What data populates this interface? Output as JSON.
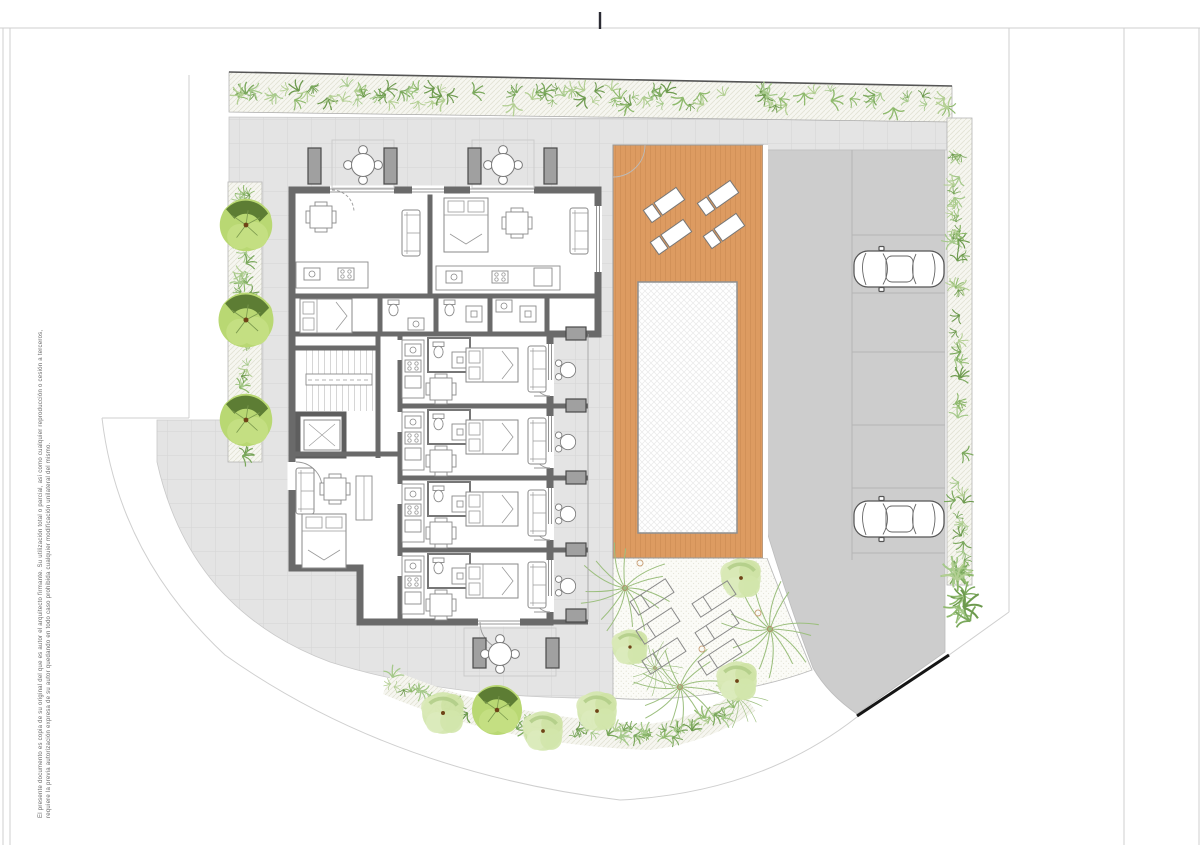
{
  "document": {
    "kind": "architectural-site-plan",
    "disclaimer": {
      "line1": "El presente documento es copia de su original del que es autor el arquitecto firmante. Su utilización total o parcial, así como cualquier reproducción o cesión a terceros,",
      "line2": "requiere la previa autorización expresa de su autor quedando en todo caso prohibida cualquier modificación unilateral del mismo."
    }
  },
  "palette": {
    "plaza": "#e4e4e4",
    "plaza_grid": "#d5d5d5",
    "driveway": "#cdcdcd",
    "driveway_line": "#b5b5b5",
    "deck": "#dd9b61",
    "deck_plank": "#c6854d",
    "pool_border": "#8f8f8f",
    "wall": "#6a6a6a",
    "hedge_bg": "#f6f6f0",
    "hedge_hatch": "#e2e2d4",
    "garden_bg": "#fbfbf7",
    "garden_dot": "#dcdccb",
    "tree_light": "#b9d873",
    "tree_dark": "#55752f",
    "tree_pale": "#d2e5ab",
    "tree_patch": "#aecb84",
    "trunk_dot": "#6f4317",
    "palm": "#9cbf7e",
    "frame_line": "#cfcfcf",
    "cut_mark": "#2b2b33",
    "exit_edge": "#161616",
    "sprig_greens": [
      "#8fba6d",
      "#7aa85c",
      "#a5c98a",
      "#6d9a4e",
      "#b3cf93"
    ]
  },
  "site": {
    "parking": {
      "stall_lines_y": [
        235,
        293,
        352,
        425,
        488,
        553
      ],
      "cars": [
        {
          "x": 853,
          "y": 248,
          "rot": 0
        },
        {
          "x": 853,
          "y": 498,
          "rot": 0
        }
      ]
    },
    "trees_left": [
      {
        "x": 246,
        "y": 225,
        "s": 1.05
      },
      {
        "x": 246,
        "y": 320,
        "s": 1.1
      },
      {
        "x": 246,
        "y": 420,
        "s": 1.05
      }
    ],
    "trees_bottom": [
      {
        "x": 443,
        "y": 713,
        "s": 0.95,
        "kind": "pale"
      },
      {
        "x": 497,
        "y": 710,
        "s": 1.0,
        "kind": "two"
      },
      {
        "x": 543,
        "y": 731,
        "s": 0.9,
        "kind": "pale"
      },
      {
        "x": 597,
        "y": 711,
        "s": 0.9,
        "kind": "pale"
      }
    ],
    "trees_garden": [
      {
        "x": 630,
        "y": 647,
        "s": 0.8,
        "kind": "pale"
      },
      {
        "x": 741,
        "y": 578,
        "s": 0.9,
        "kind": "pale"
      },
      {
        "x": 737,
        "y": 681,
        "s": 0.9,
        "kind": "pale"
      }
    ],
    "palms": [
      {
        "x": 625,
        "y": 588,
        "s": 1.0
      },
      {
        "x": 680,
        "y": 687,
        "s": 1.0
      },
      {
        "x": 770,
        "y": 629,
        "s": 1.05
      },
      {
        "x": 655,
        "y": 668,
        "s": 0.6
      },
      {
        "x": 738,
        "y": 698,
        "s": 0.65
      }
    ],
    "deck_loungers": [
      {
        "x": 664,
        "y": 205,
        "rot": -35
      },
      {
        "x": 718,
        "y": 198,
        "rot": -35
      },
      {
        "x": 671,
        "y": 237,
        "rot": -35
      },
      {
        "x": 724,
        "y": 231,
        "rot": -35
      }
    ],
    "garden_loungers": [
      {
        "x": 652,
        "y": 597,
        "rot": -33
      },
      {
        "x": 714,
        "y": 599,
        "rot": -33
      },
      {
        "x": 658,
        "y": 626,
        "rot": -33
      },
      {
        "x": 717,
        "y": 628,
        "rot": -33
      },
      {
        "x": 664,
        "y": 656,
        "rot": -33
      },
      {
        "x": 720,
        "y": 657,
        "rot": -33
      }
    ],
    "terrace_tables": [
      {
        "x": 363,
        "y": 165
      },
      {
        "x": 503,
        "y": 165
      },
      {
        "x": 500,
        "y": 654
      }
    ],
    "balcony_tables": [
      {
        "x": 568,
        "y": 370
      },
      {
        "x": 568,
        "y": 442
      },
      {
        "x": 568,
        "y": 514
      },
      {
        "x": 568,
        "y": 586
      }
    ],
    "planters": [
      {
        "x": 308,
        "y": 148,
        "w": 13,
        "h": 36
      },
      {
        "x": 384,
        "y": 148,
        "w": 13,
        "h": 36
      },
      {
        "x": 468,
        "y": 148,
        "w": 13,
        "h": 36
      },
      {
        "x": 544,
        "y": 148,
        "w": 13,
        "h": 36
      },
      {
        "x": 473,
        "y": 638,
        "w": 13,
        "h": 30
      },
      {
        "x": 546,
        "y": 638,
        "w": 13,
        "h": 30
      },
      {
        "x": 566,
        "y": 399,
        "w": 20,
        "h": 13
      },
      {
        "x": 566,
        "y": 471,
        "w": 20,
        "h": 13
      },
      {
        "x": 566,
        "y": 543,
        "w": 20,
        "h": 13
      },
      {
        "x": 566,
        "y": 327,
        "w": 20,
        "h": 13
      },
      {
        "x": 566,
        "y": 609,
        "w": 20,
        "h": 13
      }
    ],
    "irrigation_dots": [
      {
        "x": 640,
        "y": 563
      },
      {
        "x": 702,
        "y": 649
      },
      {
        "x": 758,
        "y": 613
      }
    ],
    "sprig_bands": [
      {
        "p0": [
          236,
          92
        ],
        "p1": [
          590,
          97
        ],
        "p2": [
          952,
          101
        ],
        "n": 95,
        "w": 16,
        "s": 1.1
      },
      {
        "p0": [
          245,
          190
        ],
        "p1": [
          245,
          320
        ],
        "p2": [
          245,
          454
        ],
        "n": 42,
        "w": 11,
        "s": 1.0
      },
      {
        "p0": [
          956,
          124
        ],
        "p1": [
          958,
          350
        ],
        "p2": [
          960,
          580
        ],
        "n": 55,
        "w": 9,
        "s": 1.0
      },
      {
        "p0": [
          950,
          555
        ],
        "p1": [
          962,
          600
        ],
        "p2": [
          976,
          640
        ],
        "n": 14,
        "w": 10,
        "s": 1.7
      },
      {
        "p0": [
          388,
          682
        ],
        "p1": [
          505,
          732
        ],
        "p2": [
          650,
          737
        ],
        "n": 48,
        "w": 13,
        "s": 1.1
      },
      {
        "p0": [
          650,
          737
        ],
        "p1": [
          705,
          730
        ],
        "p2": [
          748,
          700
        ],
        "n": 16,
        "w": 10,
        "s": 1.1
      }
    ]
  }
}
